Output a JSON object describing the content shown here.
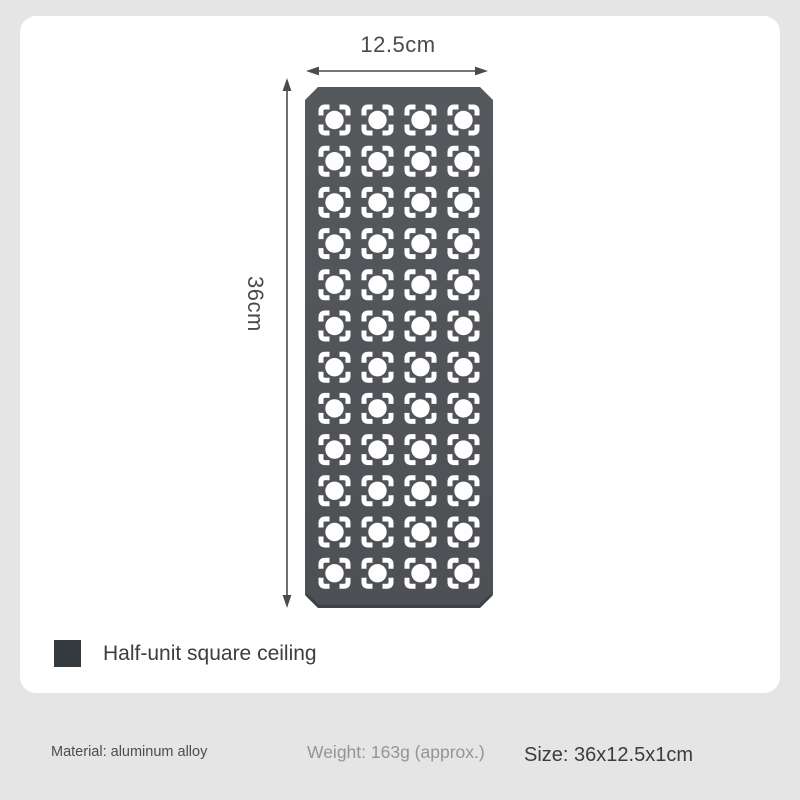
{
  "page": {
    "background": "#e5e5e5",
    "card_background": "#ffffff"
  },
  "dimensions": {
    "width_label": "12.5cm",
    "height_label": "36cm",
    "line_color": "#4b4b4b"
  },
  "panel": {
    "rows": 12,
    "cols": 4,
    "color": "#55585c",
    "color_dark": "#4d5054",
    "edge_color": "#3f4246",
    "hole_color": "#fefefe"
  },
  "legend": {
    "swatch_color": "#343a3e",
    "label": "Half-unit square ceiling"
  },
  "footer": {
    "material": "Material: aluminum alloy",
    "weight": "Weight: 163g (approx.)",
    "size": "Size: 36x12.5x1cm"
  }
}
